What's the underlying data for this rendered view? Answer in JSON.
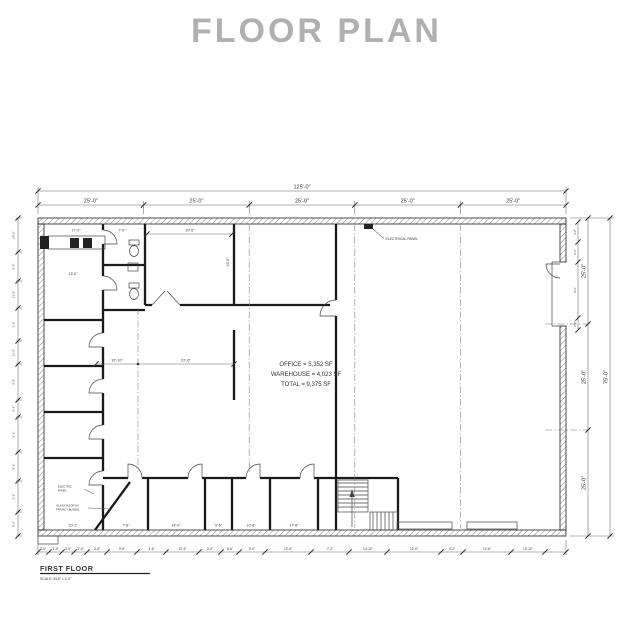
{
  "title": "FLOOR PLAN",
  "colors": {
    "title": "#b0b0b0",
    "ink": "#333333"
  },
  "drawing": {
    "dims": {
      "overall_width": "125'-0\"",
      "overall_depth": "75'-0\"",
      "top_segments": [
        "25'-0\"",
        "25'-0\"",
        "25'-0\"",
        "25'-0\"",
        "25'-0\""
      ],
      "right_segments": [
        "25'-0\"",
        "25'-0\"",
        "25'-0\""
      ]
    },
    "area_summary": {
      "office": "OFFICE = 5,352 SF",
      "warehouse": "WAREHOUSE = 4,023 SF",
      "total": "TOTAL = 9,375 SF"
    },
    "labels": {
      "electrical_panel": "ELECTRICAL PANEL",
      "note_electric_line1": "ELECTRIC",
      "note_electric_line2": "PANEL",
      "note_door_line1": "GLASS DOOR W/",
      "note_door_line2": "PRIVACY BLINDS"
    },
    "room_dims": {
      "reception_width": "17'-0\"",
      "corridor": "7'-0\"",
      "conference_width": "20'-6\"",
      "conference_depth": "16'-6\"",
      "reception_depth": "13'-0\"",
      "open_left": "10'-10\"",
      "open_right": "22'-6\"",
      "office1": "10'-2\"",
      "office2": "7'-8\"",
      "office3": "14'-6\"",
      "office4": "5'-6\"",
      "office5": "10'-6\"",
      "office6": "17'-8\""
    },
    "left_dims": [
      "10'-2\"",
      "3'-0\"",
      "11'-6\"",
      "2'-6\"",
      "11'-6\"",
      "3'-0\"",
      "9'-6\"",
      "3'-2\"",
      "8'-6\"",
      "3'-2\"",
      "5'-6\""
    ],
    "bottom_dims": [
      "3'-0\"",
      "3'-0\"",
      "3'-0\"",
      "3'-0\"",
      "3'-6\"",
      "9'-6\"",
      "3'-6\"",
      "12'-6\"",
      "3'-0\"",
      "8'-6\"",
      "3'-0\"",
      "12'-6\"",
      "7'-2\"",
      "14'-10\"",
      "12'-6\"",
      "4'-2\"",
      "12'-6\"",
      "10'-10\""
    ],
    "right_door_dims": [
      "4'-0\"",
      "2'-0\"",
      "8'-0\"",
      "2'-0\""
    ],
    "title_block": {
      "name": "FIRST FLOOR",
      "scale": "SCALE: 3/16\" = 1'-0\""
    }
  }
}
